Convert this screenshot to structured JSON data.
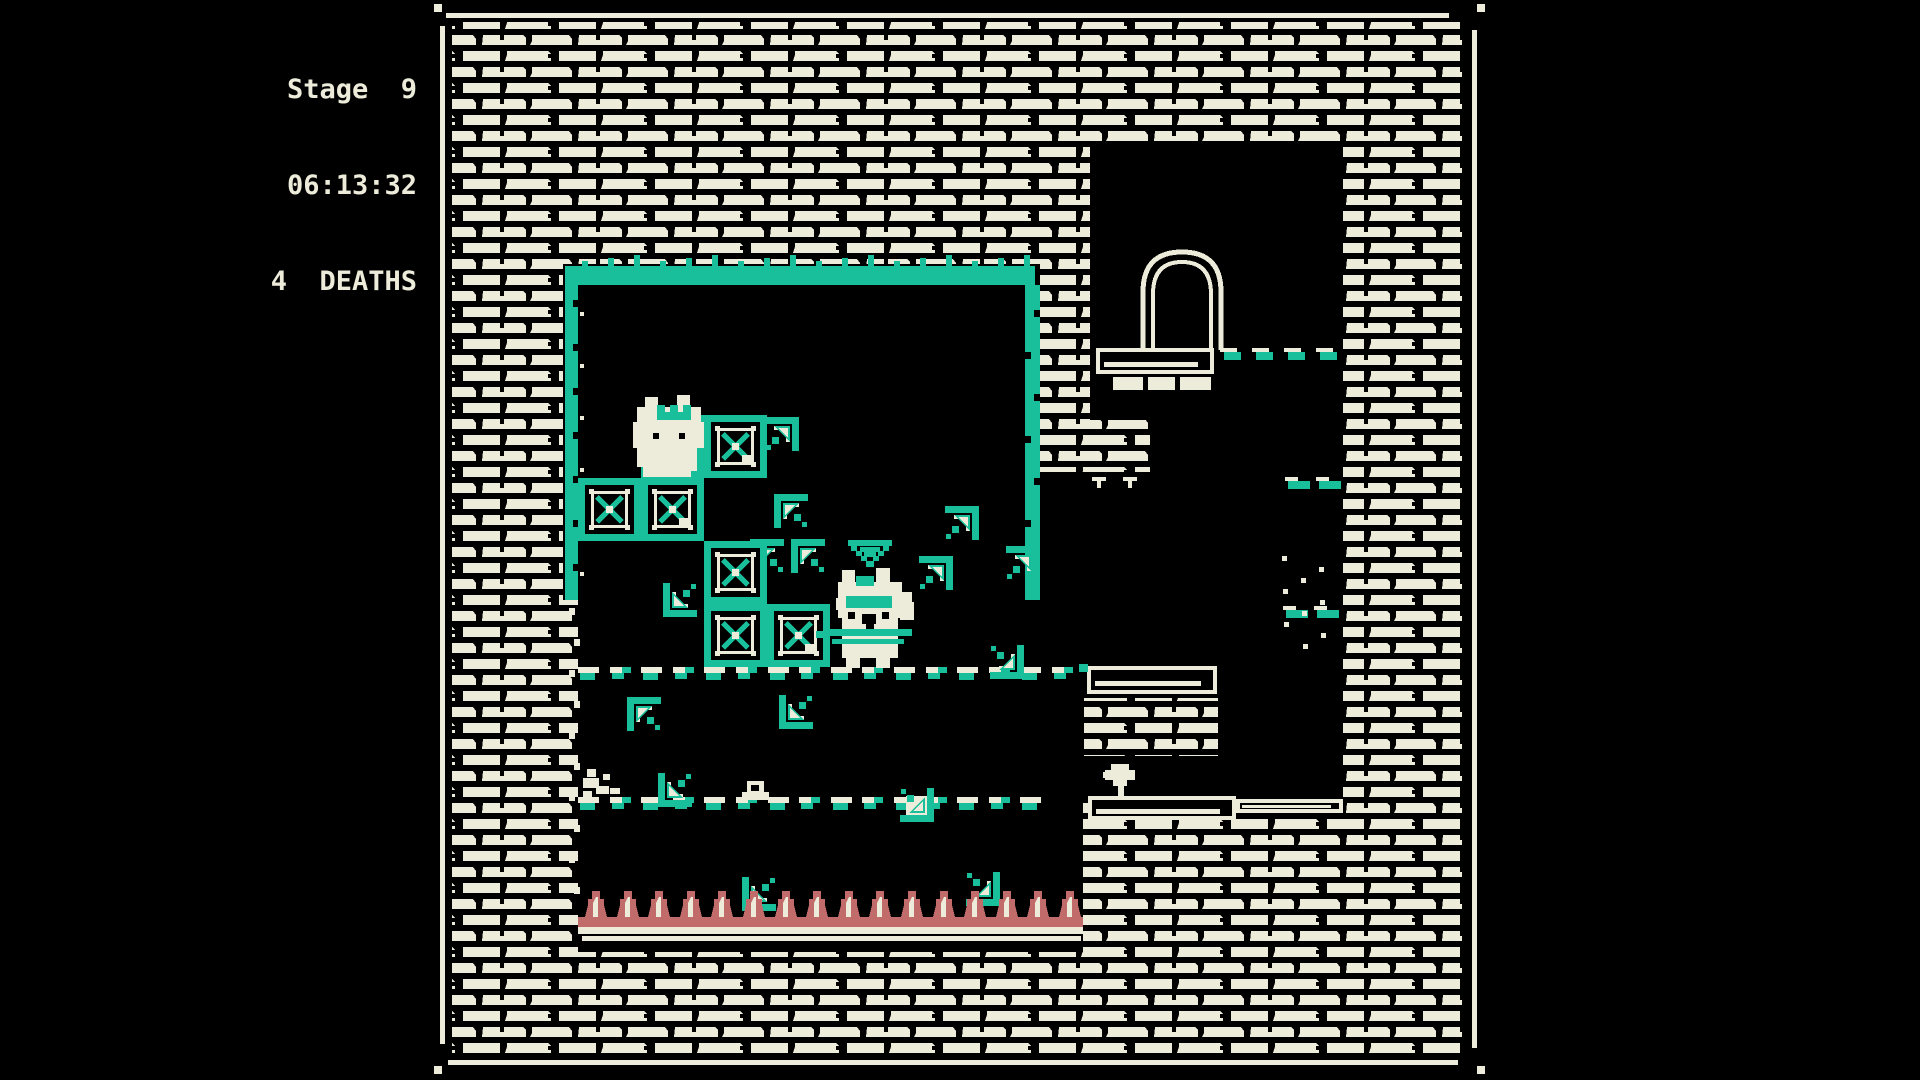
{
  "hud": {
    "stage_label": "Stage  9",
    "timer": "06:13:32",
    "deaths_label": "4  DEATHS"
  },
  "colors": {
    "cream": "#EDEBD9",
    "teal": "#18BF9A",
    "rose": "#C26B6B",
    "background": "#000000"
  },
  "game": {
    "viewport": {
      "x": 434,
      "y": 0,
      "w": 1050,
      "h": 1080
    },
    "brick_area": [
      452,
      22,
      1010,
      1032
    ],
    "border": {
      "lines": [
        [
          446,
          13,
          1003,
          5
        ],
        [
          448,
          1060,
          1010,
          5
        ],
        [
          440,
          26,
          5,
          1018
        ],
        [
          1472,
          30,
          5,
          1018
        ]
      ],
      "corner_dots": [
        [
          434,
          4,
          8,
          8
        ],
        [
          1477,
          4,
          8,
          8
        ],
        [
          434,
          1066,
          8,
          8
        ],
        [
          1477,
          1066,
          8,
          8
        ]
      ]
    },
    "cutouts": [
      [
        563,
        264,
        477,
        336
      ],
      [
        578,
        600,
        765,
        197
      ],
      [
        1040,
        472,
        303,
        128
      ],
      [
        1090,
        147,
        253,
        325
      ],
      [
        578,
        797,
        505,
        155
      ]
    ],
    "brick_patches": [
      [
        1078,
        420,
        72,
        52
      ],
      [
        1084,
        698,
        134,
        58
      ]
    ],
    "teal_walls": {
      "top": [
        577,
        266,
        458,
        19
      ],
      "left": [
        565,
        266,
        13,
        334
      ],
      "right": [
        1025,
        285,
        15,
        315
      ]
    },
    "boxes": [
      {
        "x": 641,
        "y": 415,
        "type": "arrow"
      },
      {
        "x": 704,
        "y": 415,
        "type": "x",
        "chip": true
      },
      {
        "x": 578,
        "y": 478,
        "type": "x",
        "chip": false
      },
      {
        "x": 641,
        "y": 478,
        "type": "x",
        "chip": true
      },
      {
        "x": 704,
        "y": 541,
        "type": "x",
        "chip": false
      },
      {
        "x": 704,
        "y": 604,
        "type": "x",
        "chip": false
      },
      {
        "x": 767,
        "y": 604,
        "type": "x",
        "chip": true
      }
    ],
    "arrows": [
      {
        "x": 750,
        "y": 539,
        "dir": "tl",
        "bg": false
      },
      {
        "x": 765,
        "y": 417,
        "dir": "tr",
        "bg": false
      },
      {
        "x": 774,
        "y": 494,
        "dir": "tl",
        "bg": false
      },
      {
        "x": 791,
        "y": 539,
        "dir": "tl",
        "bg": false
      },
      {
        "x": 663,
        "y": 583,
        "dir": "bl",
        "bg": false
      },
      {
        "x": 627,
        "y": 697,
        "dir": "tl",
        "bg": false
      },
      {
        "x": 779,
        "y": 695,
        "dir": "bl",
        "bg": false
      },
      {
        "x": 658,
        "y": 773,
        "dir": "bl",
        "bg": false
      },
      {
        "x": 900,
        "y": 788,
        "dir": "br",
        "bg": true
      },
      {
        "x": 742,
        "y": 877,
        "dir": "bl",
        "bg": false
      },
      {
        "x": 966,
        "y": 872,
        "dir": "br",
        "bg": false
      },
      {
        "x": 919,
        "y": 556,
        "dir": "tr",
        "bg": false
      },
      {
        "x": 945,
        "y": 506,
        "dir": "tr",
        "bg": false
      },
      {
        "x": 1006,
        "y": 546,
        "dir": "tr",
        "bg": false
      },
      {
        "x": 990,
        "y": 645,
        "dir": "br",
        "bg": false
      }
    ],
    "dash_lines": [
      {
        "x": 578,
        "y": 667,
        "len": 507
      },
      {
        "x": 578,
        "y": 797,
        "len": 505
      }
    ],
    "arch_dash_line": {
      "x": 1220,
      "y": 348,
      "count": 4
    },
    "ledge_dashes": [
      {
        "x": 1285,
        "y": 477
      },
      {
        "x": 1283,
        "y": 606
      }
    ],
    "planks": [
      {
        "x": 1096,
        "y": 348,
        "w": 118,
        "h": 26,
        "tick": false
      },
      {
        "x": 1087,
        "y": 666,
        "w": 130,
        "h": 28,
        "tick": true
      },
      {
        "x": 1088,
        "y": 796,
        "w": 148,
        "h": 24,
        "tick": false
      },
      {
        "x": 1236,
        "y": 799,
        "w": 107,
        "h": 14,
        "tick": false
      }
    ],
    "arch": {
      "x": 1143,
      "y": 252,
      "w": 78,
      "h": 98
    },
    "stubs": [
      [
        1113,
        377,
        30,
        13
      ],
      [
        1148,
        377,
        27,
        13
      ],
      [
        1180,
        377,
        31,
        13
      ]
    ],
    "ticks": [
      [
        1092,
        477
      ],
      [
        1123,
        477
      ]
    ],
    "cats": [
      {
        "x": 633,
        "y": 395,
        "kind": "crown-cat"
      },
      {
        "x": 836,
        "y": 568,
        "kind": "hero-cat"
      }
    ],
    "marker": {
      "x": 848,
      "y": 540
    },
    "creatures": [
      {
        "x": 1103,
        "y": 764,
        "kind": "plant"
      },
      {
        "x": 742,
        "y": 780,
        "kind": "snail"
      }
    ],
    "debris_pile": {
      "x": 583,
      "y": 768
    },
    "spikes": {
      "x": 585,
      "y_base": 917,
      "count": 16,
      "period": 31.6
    },
    "floor": {
      "x": 578,
      "y": 917,
      "len": 505
    }
  }
}
